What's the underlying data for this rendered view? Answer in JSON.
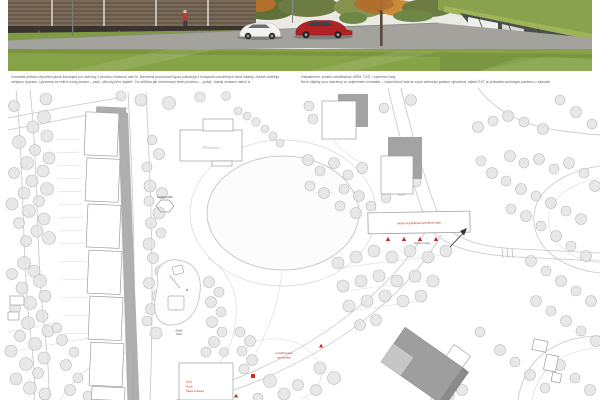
{
  "board_title": "architectural competition board",
  "caption": {
    "left_lines": [
      "Vnímáme potřebu vytvoření jasné koncepce pro všechny v prostoru Hudcova uzel té. Navržená prostorová figura pokračuje v kompozici navržených hmot lokality, čitelně odděluje",
      "veřejnou dopravu. Upravený ve vnitřní volný prostor – park, „důvody jeho náplně“. Do měřítka jak orientovaný terén prostoru – „pobyt“, každý uchazeč nabízí a"
    ],
    "right_lines": [
      "charakterem: prostor medláneček, MŠM, ČVČ, i sportovní haly.",
      "Nové objekty jsou navrženy ve vzájemném kontrastu – víceúčelová hala se svým celkovým parkem vytvořená, objekt ČVČ je příkladem archetypu pavilonu v zahradě."
    ]
  },
  "plan": {
    "labels": {
      "school": "ZŠ Hudcova",
      "bus_stop": "zastávka MHD",
      "playground_line1": "dětské",
      "playground_line2": "hřiště",
      "hall": "Nová víceúčelová sportovní hala",
      "hall_access": "přístup a vstup",
      "sport_line1": "revitalizované",
      "sport_line2": "sportoviště",
      "cvc_line1": "ČVČ",
      "cvc_line2": "Nová",
      "cvc_line3": "Šipka Lužánky"
    }
  },
  "colors": {
    "accent_red": "#cc2b22",
    "plan_line": "#c6c6c6",
    "tree_fill": "#e4e4e4",
    "building_shadow": "#a6a6a6",
    "grass": "#86a348",
    "asphalt": "#a3a29c",
    "facade_brown": "#7a6a58",
    "car_red": "#b22125"
  }
}
